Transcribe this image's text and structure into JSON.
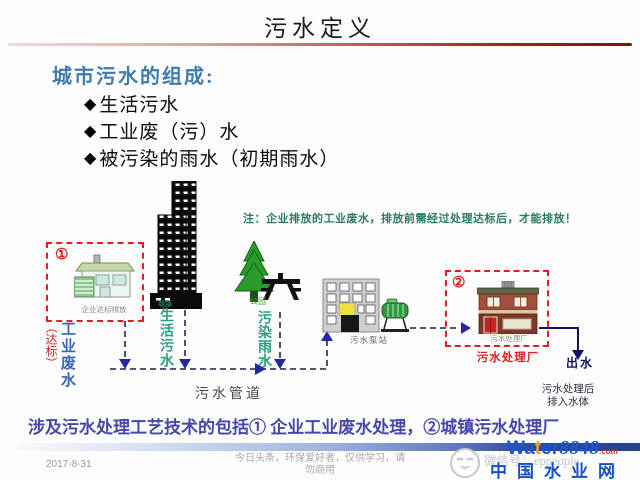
{
  "slide": {
    "title": "污水定义",
    "heading": "城市污水的组成:",
    "bullet_marker": "◆",
    "bullets": [
      "生活污水",
      "工业废（污）水",
      "被污染的雨水（初期雨水）"
    ],
    "note": "注：企业排放的工业废水，排放前需经过处理达标后，才能排放！",
    "conclusion": "涉及污水处理工艺技术的包括① 企业工业废水处理，②城镇污水处理厂"
  },
  "diagram": {
    "enterprise": {
      "number": "①",
      "caption": "企业达标排放",
      "flow_label": "工业废水",
      "flow_qualifier": "（达标）"
    },
    "city": {
      "small_label": "城镇",
      "flow_label": "生活污水"
    },
    "park": {
      "caption": "公园",
      "flow_label": "污染雨水"
    },
    "pipe_label": "污水管道",
    "pump_station": {
      "caption": "污水泵站"
    },
    "treatment_plant": {
      "number": "②",
      "caption": "污水处理厂",
      "label": "污水处理厂"
    },
    "outflow": {
      "label": "出水",
      "note_line1": "污水处理后",
      "note_line2": "排入水体"
    }
  },
  "footer": {
    "date": "2017-8-31",
    "disclaimer_line1": "今日头条，环保爱好者，仅供学习，请",
    "disclaimer_line2": "勿商用",
    "watermark": {
      "wechat_id": "微信号：eppeople",
      "brand_wa": "Wa",
      "brand_t": "t",
      "brand_er": "er",
      "brand_num": "8848",
      "brand_com": ".com",
      "site_name": "中国水业网"
    }
  },
  "colors": {
    "title_line_red": "#a32222",
    "heading_blue": "#3f7cad",
    "note_teal": "#2a7a60",
    "flow_teal": "#2aa080",
    "flow_blue": "#3a64b8",
    "alert_red": "#d62020",
    "conclusion_purple": "#4747ab",
    "brand_blue": "#1550c8"
  }
}
